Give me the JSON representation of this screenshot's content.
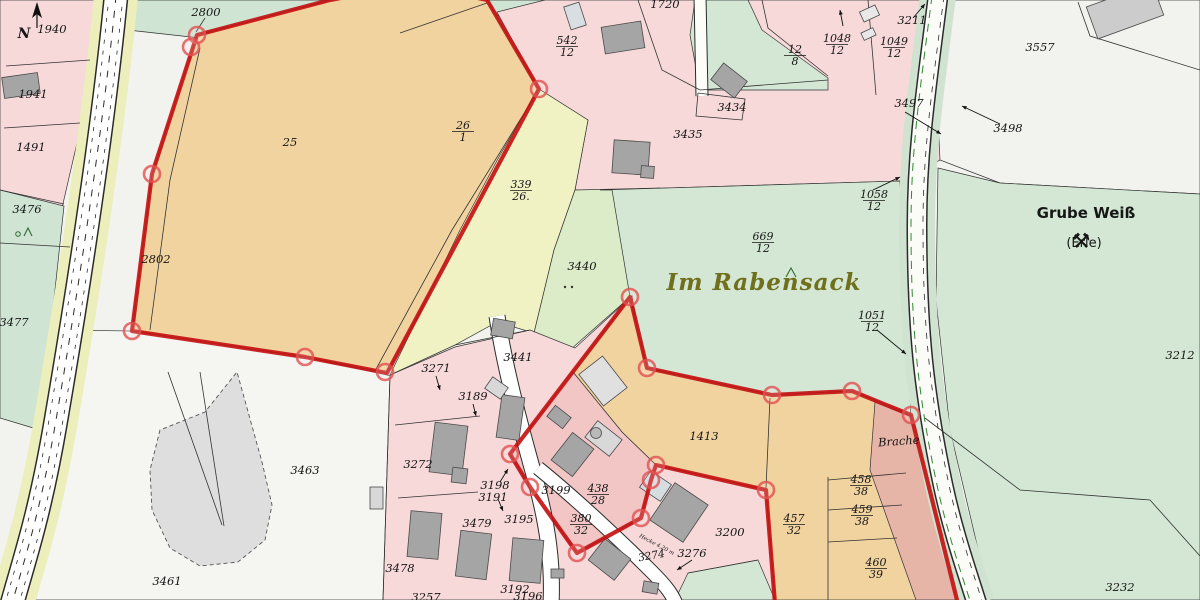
{
  "map": {
    "width": 1200,
    "height": 600,
    "colors": {
      "base": "#f2f2ef",
      "pink": "#f7d9d9",
      "pink_selected": "#f3c6c6",
      "orange": "#f1d3a0",
      "yellow": "#f1f2c4",
      "green": "#d3e7d4",
      "green_yellowish": "#dcebc8",
      "green_left": "#cfe4d3",
      "white_parcel": "#f5f5f2",
      "brache": "#e7b5a8",
      "building": "#a5a5a5",
      "building_light": "#d9dee2",
      "road_verge_yellow": "#ecefbb",
      "road_verge_green": "#cfe3d0",
      "selection_red": "#c41212",
      "line": "#333333",
      "place_text": "#6f6f1c",
      "symbol_green": "#2f6d2f"
    },
    "regions": [
      {
        "name": "pink-strip-nw",
        "points": "0,0 98,0 80,130 62,208 0,196",
        "fill": "#f7d9d9"
      },
      {
        "name": "green-3476-3477",
        "points": "0,190 64,206 40,430 0,418",
        "fill": "#cfe4d3"
      },
      {
        "name": "white-3463-3461",
        "points": "52,330 132,331 305,357 387,375 400,377 390,600 8,600 30,470",
        "fill": "#f5f5f2"
      },
      {
        "name": "green-top-strip",
        "points": "120,0 340,0 200,38 128,30",
        "fill": "#cfe4d3"
      },
      {
        "name": "green-top-center",
        "points": "470,0 575,0 545,24 480,12",
        "fill": "#cfe4d3"
      },
      {
        "name": "pink-north-residential",
        "points": "545,0 940,0 940,160 900,181 600,190 575,190 588,120 539,89 497,12",
        "fill": "#f7d9d9"
      },
      {
        "name": "green-parcel-top",
        "points": "695,0 748,0 762,30 828,78 828,90 700,90 690,35",
        "fill": "#d3e7d4"
      },
      {
        "name": "white-3557",
        "points": "935,0 1200,0 1200,194 1000,183 940,160 935,60",
        "fill": "#f2f2ef"
      },
      {
        "name": "green-east",
        "points": "938,168 1000,183 1200,194 1200,600 990,600 950,430 936,300",
        "fill": "#d3e7d4"
      },
      {
        "name": "orange-polygonA",
        "points": "330,0 415,-16 487,0 539,89 387,373 305,357 132,331 152,174 197,35",
        "fill": "#f1d3a0"
      },
      {
        "name": "yellow-339",
        "points": "539,89 588,120 575,190 554,250 534,333 497,322 455,345 390,375 460,230 500,155",
        "fill": "#f1f2c4"
      },
      {
        "name": "green-3440",
        "points": "575,190 660,188 630,297 570,350 534,333 554,250",
        "fill": "#dcebc8"
      },
      {
        "name": "green-669",
        "points": "600,190 900,181 911,417 852,391 772,395 647,368 630,297 612,190",
        "fill": "#d3e7d4"
      },
      {
        "name": "pink-village",
        "points": "383,600 390,375 455,347 530,330 575,348 632,296 656,465 766,490 775,600",
        "fill": "#f7d9d9"
      },
      {
        "name": "orange-1413-457",
        "points": "630,297 647,368 772,395 852,391 911,415 930,500 958,600 775,600 766,490 656,465 622,432 573,372",
        "fill": "#f1d3a0"
      },
      {
        "name": "pink-selected-438",
        "points": "573,372 622,432 656,465 651,480 641,518 577,553 530,487 510,454",
        "fill": "#f3c6c6"
      },
      {
        "name": "brache-strip",
        "points": "875,402 913,417 957,600 916,600 870,470",
        "fill": "#e7b5a8"
      },
      {
        "name": "green-wedge-south",
        "points": "675,600 688,573 758,560 775,600",
        "fill": "#d3e7d4"
      },
      {
        "name": "pit-3461",
        "points": "160,430 150,470 152,510 170,548 200,566 238,562 265,540 272,505 262,462 237,372 205,412",
        "fill": "#dedede",
        "stroke": "#555555",
        "sw": 0.9,
        "dash": "4,3"
      }
    ],
    "roads": [
      {
        "name": "left-road",
        "d": "M116,-4 C104,120 80,280 56,420 C40,515 24,560 12,604",
        "layers": [
          {
            "s": "#ecefbb",
            "w": 44
          },
          {
            "s": "#2b2b2b",
            "w": 25
          },
          {
            "s": "#ffffff",
            "w": 22
          },
          {
            "s": "#2b2b2b",
            "w": 1,
            "dash": "7,8"
          },
          {
            "s": "#2b2b2b",
            "w": 0.8,
            "dash": "4,7",
            "off": -7
          },
          {
            "s": "#2b2b2b",
            "w": 0.8,
            "dash": "4,7",
            "off": 7
          }
        ]
      },
      {
        "name": "right-road",
        "d": "M938,-4 C926,90 917,150 917,225 C917,330 924,395 943,485 C953,532 967,572 977,604",
        "layers": [
          {
            "s": "#cfe3d0",
            "w": 36
          },
          {
            "s": "#2b2b2b",
            "w": 21
          },
          {
            "s": "#fbfbf8",
            "w": 18
          },
          {
            "s": "#2e8a2e",
            "w": 1,
            "dash": "8,6",
            "off": -6
          },
          {
            "s": "#2b2b2b",
            "w": 0.8,
            "dash": "6,7",
            "off": 6
          }
        ]
      },
      {
        "name": "village-road-main",
        "d": "M497,316 C505,370 522,432 536,482 C548,527 553,565 551,604",
        "layers": [
          {
            "s": "#2b2b2b",
            "w": 17
          },
          {
            "s": "#ffffff",
            "w": 15
          }
        ]
      },
      {
        "name": "village-road-branch",
        "d": "M538,468 C575,498 620,540 652,572 C666,586 672,594 676,604",
        "layers": [
          {
            "s": "#2b2b2b",
            "w": 15
          },
          {
            "s": "#ffffff",
            "w": 13
          }
        ]
      },
      {
        "name": "lane-3434",
        "d": "M700,-4 L702,96",
        "layers": [
          {
            "s": "#2b2b2b",
            "w": 13
          },
          {
            "s": "#fcfcf8",
            "w": 11
          }
        ]
      }
    ],
    "lines": [
      {
        "name": "divider-1940-1941",
        "points": "6,66 90,60"
      },
      {
        "name": "divider-1941-1491",
        "points": "4,128 80,123"
      },
      {
        "name": "divider-1491-3476",
        "points": "0,190 64,204"
      },
      {
        "name": "divider-3476-3477",
        "points": "0,243 70,247"
      },
      {
        "name": "divider-2802",
        "points": "200,48 170,180 150,330"
      },
      {
        "name": "divider-25-26",
        "points": "536,94 452,230 375,371"
      },
      {
        "name": "line-2800-strip",
        "points": "400,33 487,3"
      },
      {
        "name": "leader-2800",
        "points": "205,18 196,32"
      },
      {
        "name": "divider-1720",
        "points": "638,0 662,70 700,90"
      },
      {
        "name": "pocket-3434",
        "points": "698,93 745,99 742,120 696,116 698,93"
      },
      {
        "name": "divider-12-8-top",
        "points": "700,90 828,80"
      },
      {
        "name": "divider-green-top",
        "points": "762,0 768,28 828,76"
      },
      {
        "name": "divider-1048-1049",
        "points": "868,0 876,95"
      },
      {
        "name": "steps-green-east",
        "points": "925,418 1020,490 1150,500 1200,556"
      },
      {
        "name": "parcel-3557-nw",
        "points": "1078,2 1090,36 1200,70"
      },
      {
        "name": "divider-1413-457",
        "points": "770,398 766,488"
      },
      {
        "name": "divider-457-458",
        "points": "828,477 828,600"
      },
      {
        "name": "divider-458-row",
        "points": "828,480 906,473"
      },
      {
        "name": "divider-459-row",
        "points": "828,510 902,505"
      },
      {
        "name": "divider-460-row",
        "points": "828,542 897,538"
      },
      {
        "name": "village-west-edge",
        "points": "390,375 383,600"
      },
      {
        "name": "driveway-3272",
        "points": "395,425 480,416"
      },
      {
        "name": "driveway-3478",
        "points": "398,498 478,492"
      },
      {
        "name": "pit-line-a",
        "points": "168,372 222,525"
      },
      {
        "name": "pit-line-b",
        "points": "200,372 224,526"
      },
      {
        "name": "green-wedge-top",
        "points": "688,573 758,560"
      },
      {
        "name": "boundary-3441",
        "points": "455,345 530,330"
      }
    ],
    "buildings": [
      [
        603,
        24,
        40,
        27,
        -9,
        "#a5a5a5"
      ],
      [
        567,
        4,
        16,
        24,
        -18,
        "#d9dee2"
      ],
      [
        714,
        70,
        30,
        21,
        38,
        "#a5a5a5"
      ],
      [
        613,
        141,
        36,
        33,
        4,
        "#a5a5a5"
      ],
      [
        641,
        166,
        13,
        12,
        4,
        "#a5a5a5"
      ],
      [
        1090,
        -6,
        70,
        34,
        -20,
        "#cccccc"
      ],
      [
        861,
        8,
        17,
        11,
        -25,
        "#e8e8e8"
      ],
      [
        862,
        30,
        13,
        8,
        -25,
        "#e8e8e8"
      ],
      [
        3,
        75,
        36,
        21,
        -8,
        "#a5a5a5"
      ],
      [
        432,
        424,
        33,
        50,
        7,
        "#a5a5a5"
      ],
      [
        452,
        468,
        15,
        15,
        7,
        "#a5a5a5"
      ],
      [
        409,
        512,
        31,
        46,
        5,
        "#a5a5a5"
      ],
      [
        458,
        532,
        31,
        46,
        7,
        "#a5a5a5"
      ],
      [
        511,
        539,
        31,
        43,
        5,
        "#a5a5a5"
      ],
      [
        551,
        569,
        13,
        9,
        0,
        "#a5a5a5"
      ],
      [
        583,
        366,
        40,
        30,
        52,
        "#dfe0df"
      ],
      [
        499,
        396,
        23,
        43,
        8,
        "#a5a5a5"
      ],
      [
        559,
        437,
        27,
        35,
        38,
        "#a5a5a5"
      ],
      [
        588,
        428,
        31,
        21,
        38,
        "#d8d8d8"
      ],
      [
        549,
        410,
        20,
        14,
        38,
        "#a5a5a5"
      ],
      [
        659,
        490,
        40,
        45,
        34,
        "#a5a5a5"
      ],
      [
        643,
        476,
        25,
        20,
        34,
        "#d6dde1"
      ],
      [
        593,
        546,
        33,
        27,
        38,
        "#a5a5a5"
      ],
      [
        643,
        582,
        15,
        11,
        10,
        "#a5a5a5"
      ],
      [
        492,
        320,
        22,
        17,
        10,
        "#a5a5a5"
      ],
      [
        487,
        381,
        19,
        14,
        35,
        "#d8d8d8"
      ],
      [
        370,
        487,
        13,
        22,
        0,
        "#d8d8d8"
      ]
    ],
    "selection": {
      "color": "#c41212",
      "width": 4.2,
      "paths": [
        {
          "name": "selection-north",
          "d": "M330,0 L415,-16 L487,0 L539,89 L387,373 L305,357 L132,331 L152,174 L197,35 Z"
        },
        {
          "name": "selection-south",
          "d": "M958,604 L911,415 L852,391 L772,395 L647,368 L630,297 L510,454 L530,487 L577,553 L641,518 L651,480 L656,465 L766,490 L775,604"
        }
      ],
      "vertices": [
        [
          197,
          35
        ],
        [
          191,
          47
        ],
        [
          152,
          174
        ],
        [
          132,
          331
        ],
        [
          305,
          357
        ],
        [
          385,
          372
        ],
        [
          539,
          89
        ],
        [
          630,
          297
        ],
        [
          647,
          368
        ],
        [
          772,
          395
        ],
        [
          852,
          391
        ],
        [
          911,
          415
        ],
        [
          766,
          490
        ],
        [
          656,
          465
        ],
        [
          651,
          480
        ],
        [
          641,
          518
        ],
        [
          577,
          553
        ],
        [
          530,
          487
        ],
        [
          510,
          454
        ]
      ]
    },
    "arrows": [
      [
        913,
        18,
        925,
        4
      ],
      [
        905,
        112,
        941,
        134
      ],
      [
        1000,
        124,
        962,
        106
      ],
      [
        873,
        190,
        900,
        177
      ],
      [
        877,
        330,
        906,
        354
      ],
      [
        436,
        376,
        440,
        390
      ],
      [
        473,
        404,
        476,
        416
      ],
      [
        500,
        482,
        508,
        469
      ],
      [
        498,
        499,
        503,
        511
      ],
      [
        692,
        560,
        677,
        570
      ],
      [
        843,
        26,
        840,
        10
      ]
    ],
    "labels": [
      {
        "t": "2800",
        "x": 206,
        "y": 16,
        "cls": "p"
      },
      {
        "t": "N",
        "x": 24,
        "y": 38,
        "cls": "n"
      },
      {
        "t": "1940",
        "x": 52,
        "y": 33,
        "cls": "p"
      },
      {
        "t": "1941",
        "x": 33,
        "y": 98,
        "cls": "p"
      },
      {
        "t": "1491",
        "x": 31,
        "y": 151,
        "cls": "p"
      },
      {
        "t": "3476",
        "x": 27,
        "y": 213,
        "cls": "p"
      },
      {
        "t": "3477",
        "x": 14,
        "y": 326,
        "cls": "p"
      },
      {
        "t": "2802",
        "x": 156,
        "y": 263,
        "cls": "p"
      },
      {
        "t": "25",
        "x": 290,
        "y": 146,
        "cls": "p"
      },
      {
        "t": "1720",
        "x": 665,
        "y": 8,
        "cls": "p"
      },
      {
        "t": "3434",
        "x": 732,
        "y": 111,
        "cls": "p"
      },
      {
        "t": "3435",
        "x": 688,
        "y": 138,
        "cls": "p"
      },
      {
        "t": "3211",
        "x": 912,
        "y": 24,
        "cls": "p"
      },
      {
        "t": "3497",
        "x": 909,
        "y": 107,
        "cls": "p"
      },
      {
        "t": "3498",
        "x": 1008,
        "y": 132,
        "cls": "p"
      },
      {
        "t": "3557",
        "x": 1040,
        "y": 51,
        "cls": "p"
      },
      {
        "t": "Grube Weiß",
        "x": 1086,
        "y": 218,
        "cls": "ti"
      },
      {
        "t": "(Erle)",
        "x": 1084,
        "y": 247,
        "cls": "sub"
      },
      {
        "t": "Im Rabensack",
        "x": 764,
        "y": 290,
        "cls": "pl"
      },
      {
        "t": "3212",
        "x": 1180,
        "y": 359,
        "cls": "p"
      },
      {
        "t": "3232",
        "x": 1120,
        "y": 591,
        "cls": "p"
      },
      {
        "t": "3440",
        "x": 582,
        "y": 270,
        "cls": "p"
      },
      {
        "t": "3441",
        "x": 518,
        "y": 361,
        "cls": "p"
      },
      {
        "t": "3271",
        "x": 436,
        "y": 372,
        "cls": "p"
      },
      {
        "t": "3189",
        "x": 473,
        "y": 400,
        "cls": "p"
      },
      {
        "t": "3463",
        "x": 305,
        "y": 474,
        "cls": "p"
      },
      {
        "t": "3461",
        "x": 167,
        "y": 585,
        "cls": "p"
      },
      {
        "t": "3272",
        "x": 418,
        "y": 468,
        "cls": "p"
      },
      {
        "t": "3198",
        "x": 495,
        "y": 489,
        "cls": "p"
      },
      {
        "t": "3191",
        "x": 493,
        "y": 501,
        "cls": "p"
      },
      {
        "t": "3199",
        "x": 556,
        "y": 494,
        "cls": "p"
      },
      {
        "t": "3195",
        "x": 519,
        "y": 523,
        "cls": "p"
      },
      {
        "t": "3479",
        "x": 477,
        "y": 527,
        "cls": "p"
      },
      {
        "t": "3478",
        "x": 400,
        "y": 572,
        "cls": "p"
      },
      {
        "t": "3192",
        "x": 515,
        "y": 593,
        "cls": "p"
      },
      {
        "t": "3196",
        "x": 528,
        "y": 600,
        "cls": "p"
      },
      {
        "t": "3257",
        "x": 426,
        "y": 601,
        "cls": "p"
      },
      {
        "t": "3200",
        "x": 730,
        "y": 536,
        "cls": "p"
      },
      {
        "t": "1413",
        "x": 704,
        "y": 440,
        "cls": "p"
      },
      {
        "t": "Brache",
        "x": 899,
        "y": 445,
        "cls": "p",
        "rot": -4
      },
      {
        "t": "3274",
        "x": 652,
        "y": 559,
        "cls": "psm",
        "rot": -10
      },
      {
        "t": "3276",
        "x": 692,
        "y": 557,
        "cls": "p"
      },
      {
        "t": "Hecke 4,20 m",
        "x": 656,
        "y": 546,
        "cls": "tiny",
        "rot": 28
      }
    ],
    "fractions": [
      {
        "n": "26",
        "d": "1",
        "x": 463,
        "y": 129
      },
      {
        "n": "339",
        "d": "26.",
        "x": 521,
        "y": 188
      },
      {
        "n": "542",
        "d": "12",
        "x": 567,
        "y": 44
      },
      {
        "n": "12",
        "d": "8",
        "x": 795,
        "y": 53
      },
      {
        "n": "1048",
        "d": "12",
        "x": 837,
        "y": 42
      },
      {
        "n": "1049",
        "d": "12",
        "x": 894,
        "y": 45
      },
      {
        "n": "1058",
        "d": "12",
        "x": 874,
        "y": 198
      },
      {
        "n": "669",
        "d": "12",
        "x": 763,
        "y": 240
      },
      {
        "n": "1051",
        "d": "12",
        "x": 872,
        "y": 319
      },
      {
        "n": "438",
        "d": "28",
        "x": 598,
        "y": 492
      },
      {
        "n": "380",
        "d": "32",
        "x": 581,
        "y": 522
      },
      {
        "n": "457",
        "d": "32",
        "x": 794,
        "y": 522
      },
      {
        "n": "458",
        "d": "38",
        "x": 861,
        "y": 483
      },
      {
        "n": "459",
        "d": "38",
        "x": 862,
        "y": 513
      },
      {
        "n": "460",
        "d": "39",
        "x": 876,
        "y": 566
      }
    ],
    "symbols": {
      "north_arrow": {
        "x": 37,
        "y": 14
      },
      "tree_3476": {
        "x": 18,
        "y": 234
      },
      "caret_669": {
        "x": 786,
        "y": 277
      },
      "dots_3440": {
        "x": 565,
        "y": 287
      },
      "mine_sign": {
        "x": 1081,
        "y": 248,
        "glyph": "⚒"
      },
      "round_building": {
        "x": 596,
        "y": 433,
        "r": 5.5
      }
    }
  }
}
